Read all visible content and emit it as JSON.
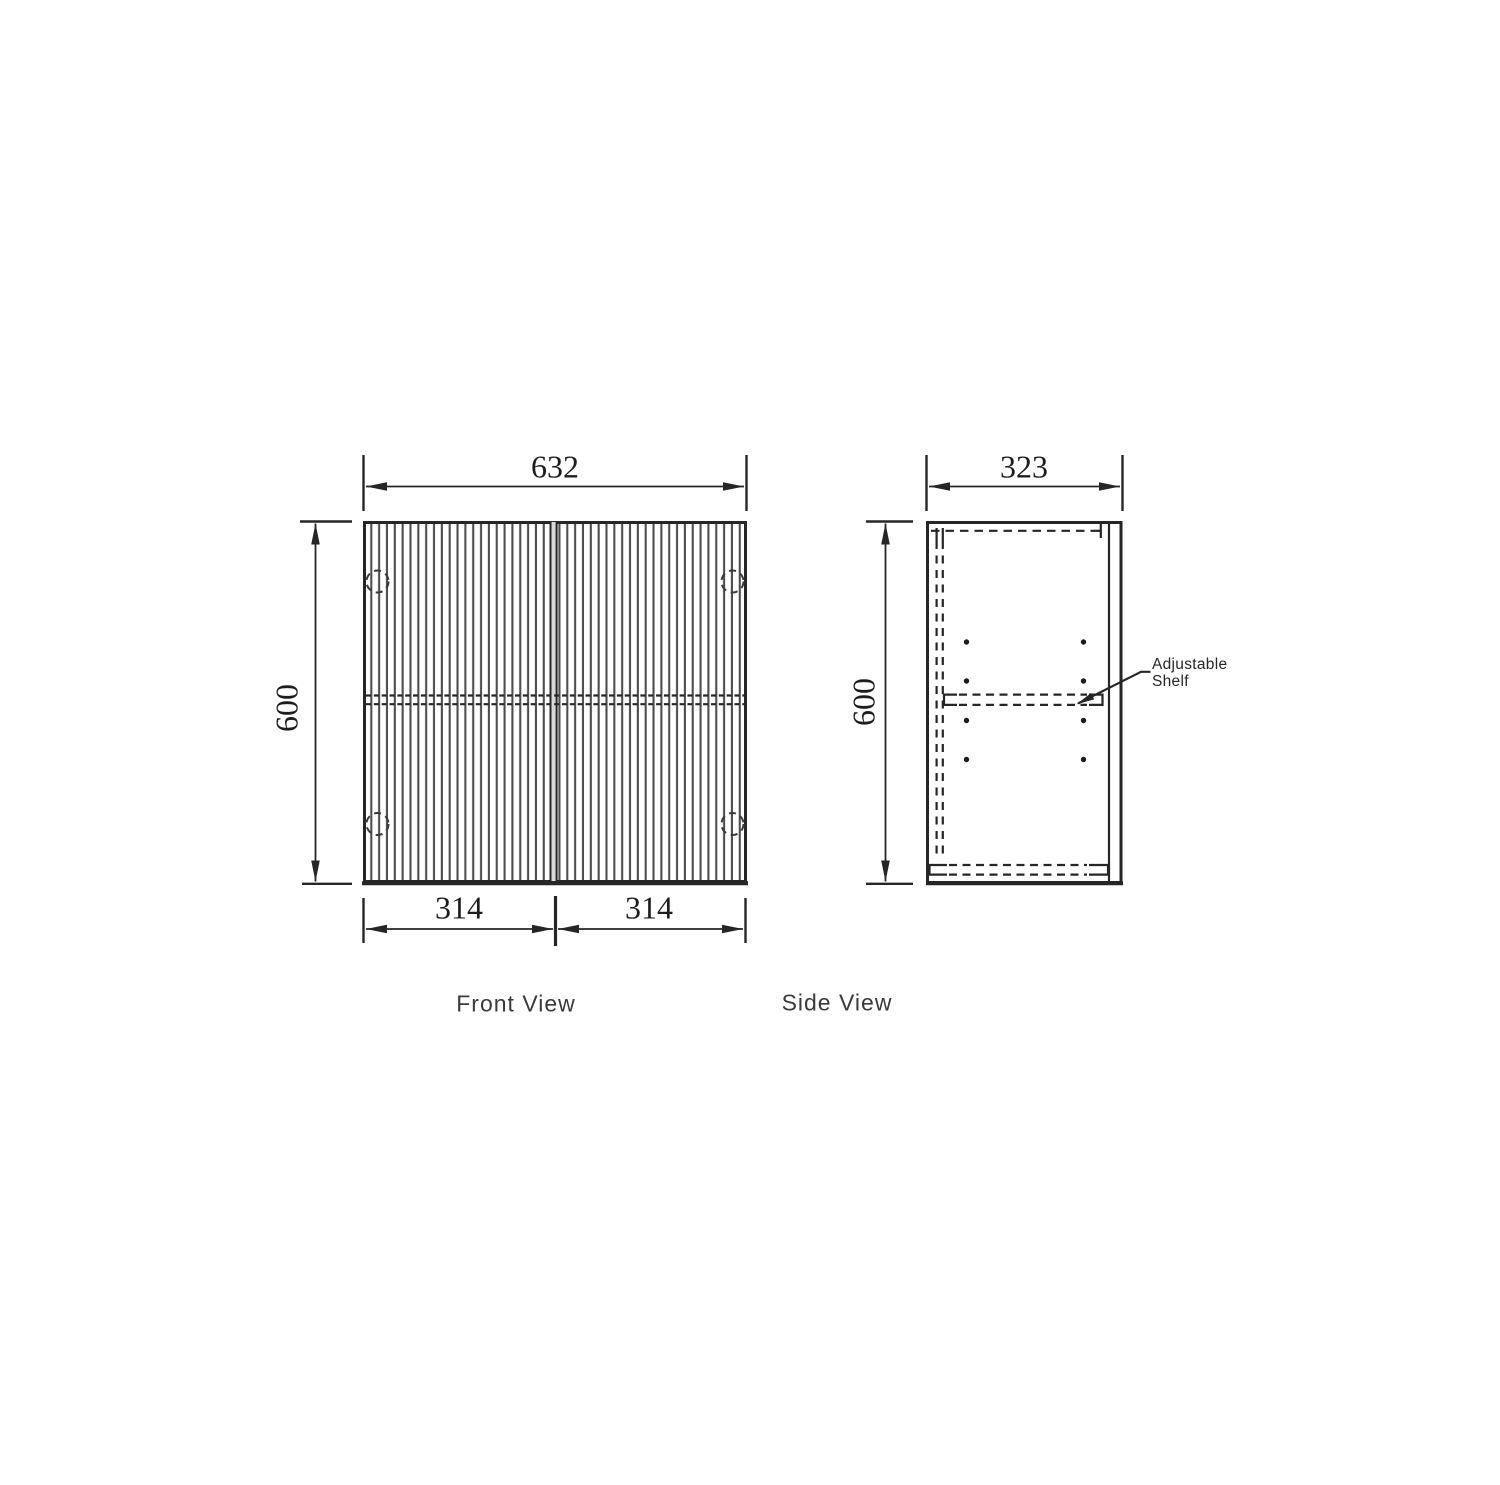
{
  "drawing": {
    "type": "cabinet-technical-drawing",
    "line_color": "#262626",
    "flute_color": "#4d4d4d",
    "background": "#ffffff",
    "front_view": {
      "label": "Front View",
      "width_dim": "632",
      "height_dim": "600",
      "left_door_dim": "314",
      "right_door_dim": "314"
    },
    "side_view": {
      "label": "Side View",
      "depth_dim": "323",
      "height_dim": "600",
      "shelf_label": "Adjustable Shelf"
    }
  }
}
